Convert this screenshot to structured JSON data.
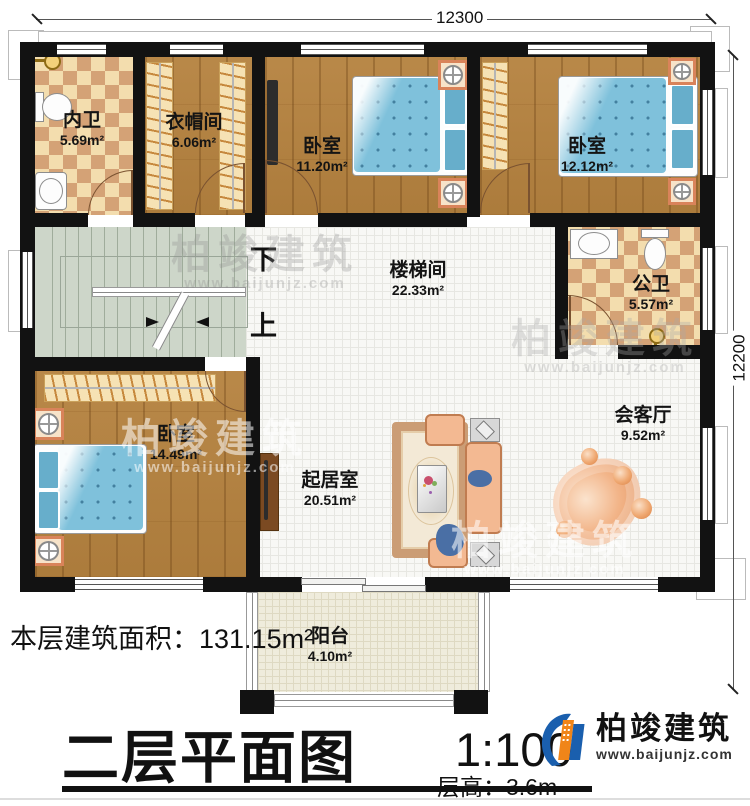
{
  "plan": {
    "rooms": [
      {
        "id": "inner-bath",
        "name": "内卫",
        "area": "5.69m²"
      },
      {
        "id": "cloakroom",
        "name": "衣帽间",
        "area": "6.06m²"
      },
      {
        "id": "bedroom-top",
        "name": "卧室",
        "area": "11.20m²"
      },
      {
        "id": "bedroom-right",
        "name": "卧室",
        "area": "12.12m²"
      },
      {
        "id": "public-bath",
        "name": "公卫",
        "area": "5.57m²"
      },
      {
        "id": "stair-hall",
        "name": "楼梯间",
        "area": "22.33m²"
      },
      {
        "id": "bedroom-left",
        "name": "卧室",
        "area": "14.49m²"
      },
      {
        "id": "living-room",
        "name": "起居室",
        "area": "20.51m²"
      },
      {
        "id": "reception",
        "name": "会客厅",
        "area": "9.52m²"
      },
      {
        "id": "balcony",
        "name": "阳台",
        "area": "4.10m²"
      }
    ],
    "stairs": {
      "down_label": "下",
      "up_label": "上"
    },
    "dimensions": {
      "top": "12300",
      "right": "12200"
    }
  },
  "footer": {
    "area_label": "本层建筑面积：",
    "area_value": "131.15m²",
    "title": "二层平面图",
    "scale": "1:100",
    "floor_height_label": "层高：",
    "floor_height_value": "3.6m"
  },
  "brand": {
    "name": "柏竣建筑",
    "website": "www.baijunjz.com"
  },
  "colors": {
    "wall": "#121212",
    "wood": "#b5823f",
    "tile": "#f8f8f5",
    "checker_dark": "#d4a276",
    "checker_light": "#f3ddae",
    "stairs": "#cdd6c9",
    "balcony": "#efecdc",
    "mattress": "#7fc1db",
    "brand_blue": "#1a5fae",
    "brand_orange": "#f08519"
  }
}
